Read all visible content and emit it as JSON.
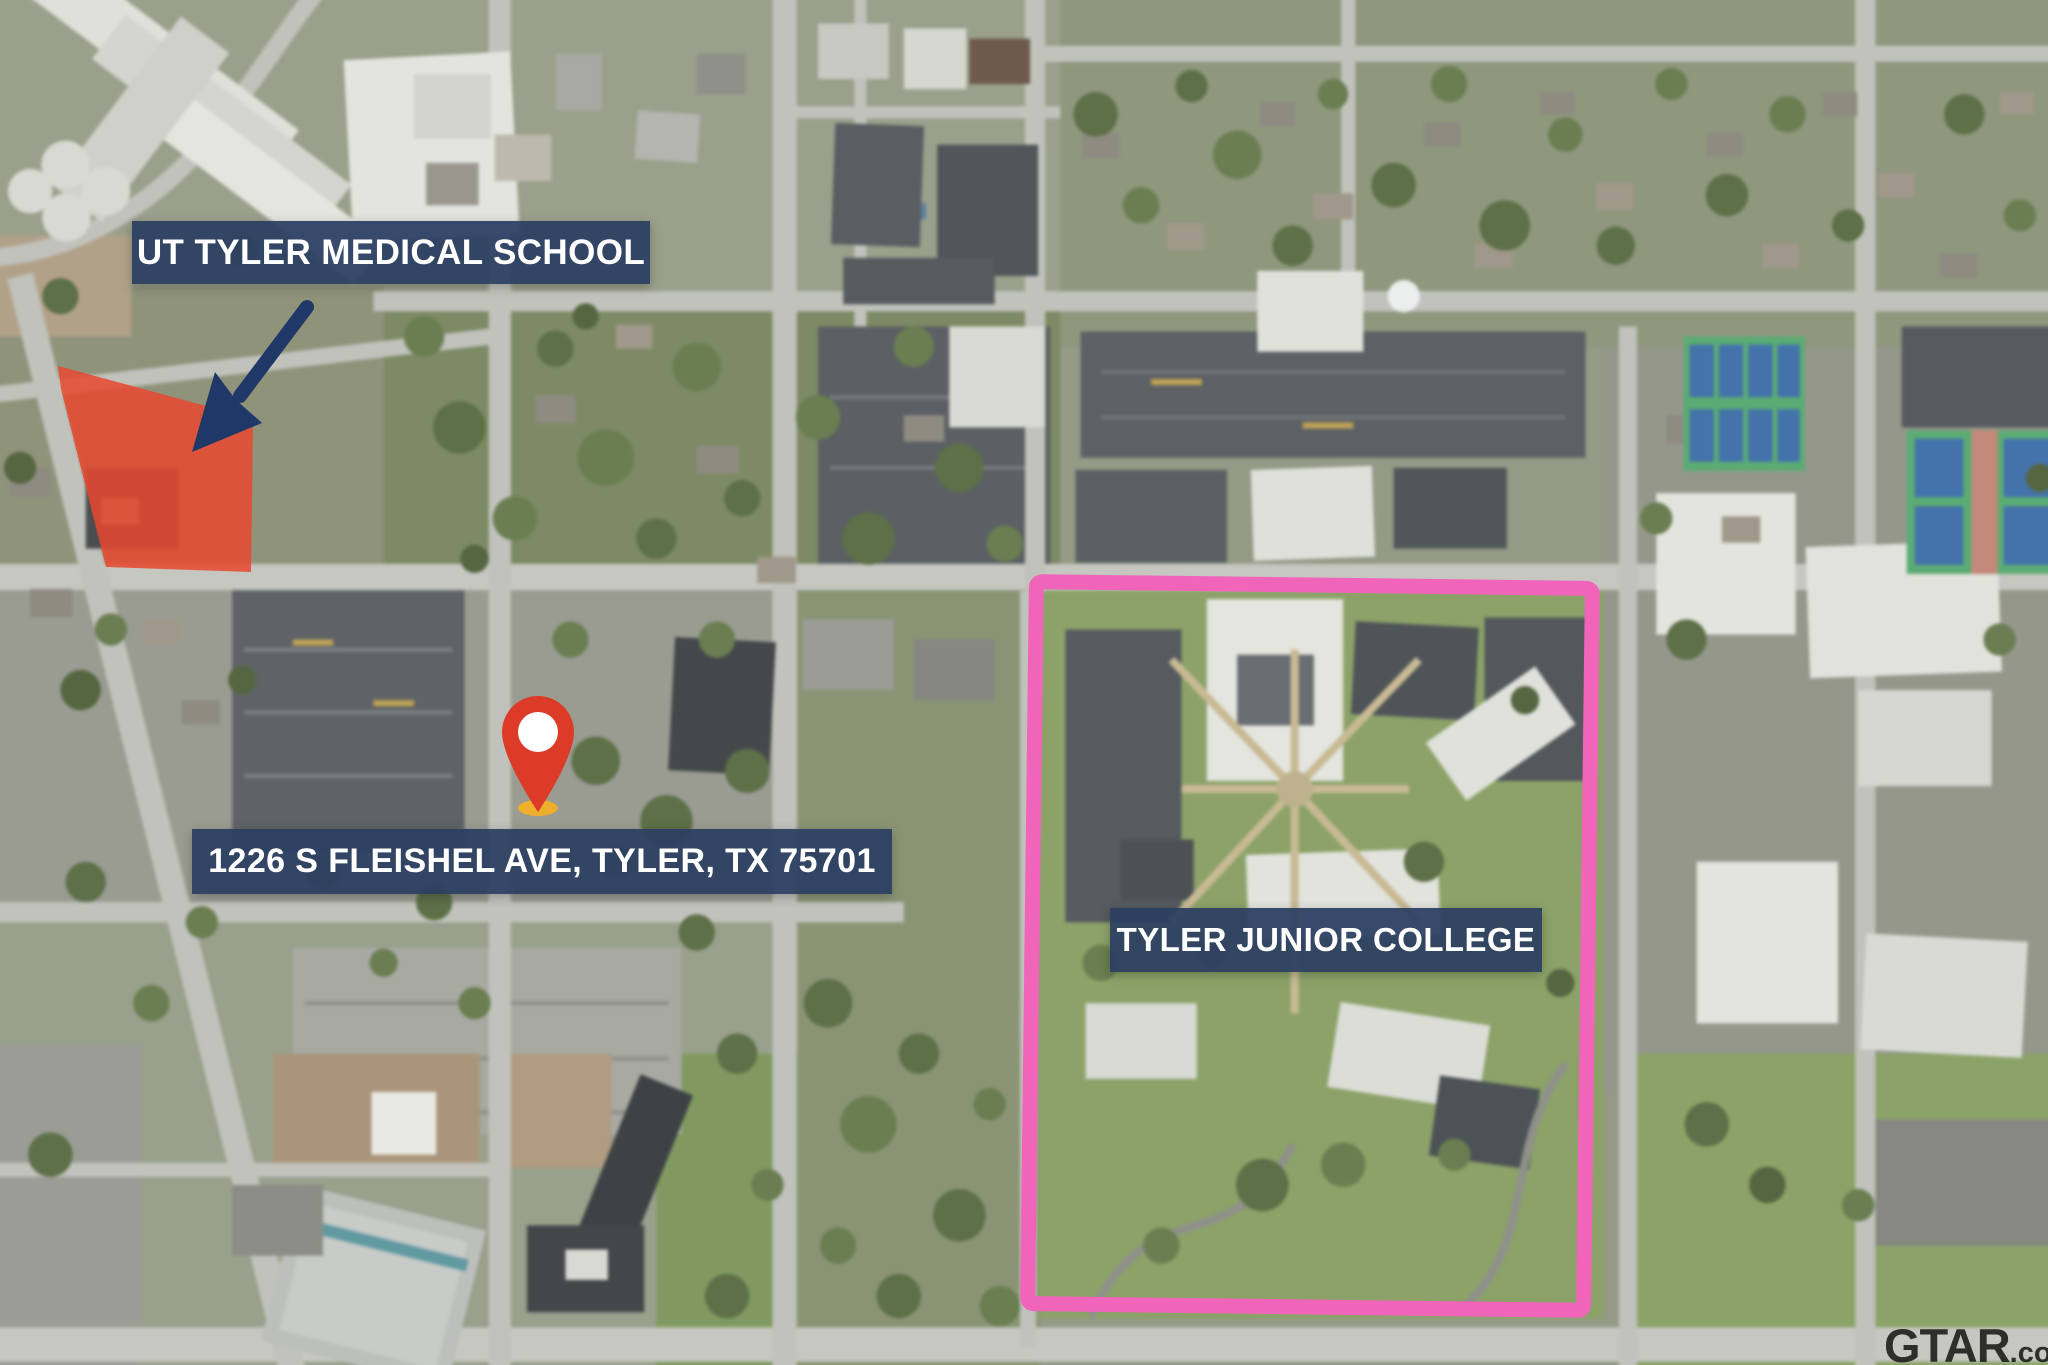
{
  "annotations": {
    "medical_school": {
      "label": "UT TYLER MEDICAL SCHOOL"
    },
    "property": {
      "label": "1226 S FLEISHEL AVE, TYLER, TX 75701"
    },
    "college": {
      "label": "TYLER JUNIOR COLLEGE"
    }
  },
  "watermark": {
    "text": "GTAR",
    "suffix": ".com"
  },
  "colors": {
    "label_bg": "rgba(43,62,98,0.93)",
    "label_text": "#ffffff",
    "arrow": "#1f3868",
    "highlight_red": "#e7482f",
    "outline_pink": "#f065ba",
    "pin_red": "#dc3b28",
    "pin_base_gold": "#eeb02c",
    "watermark": "rgba(12,12,12,0.82)"
  }
}
